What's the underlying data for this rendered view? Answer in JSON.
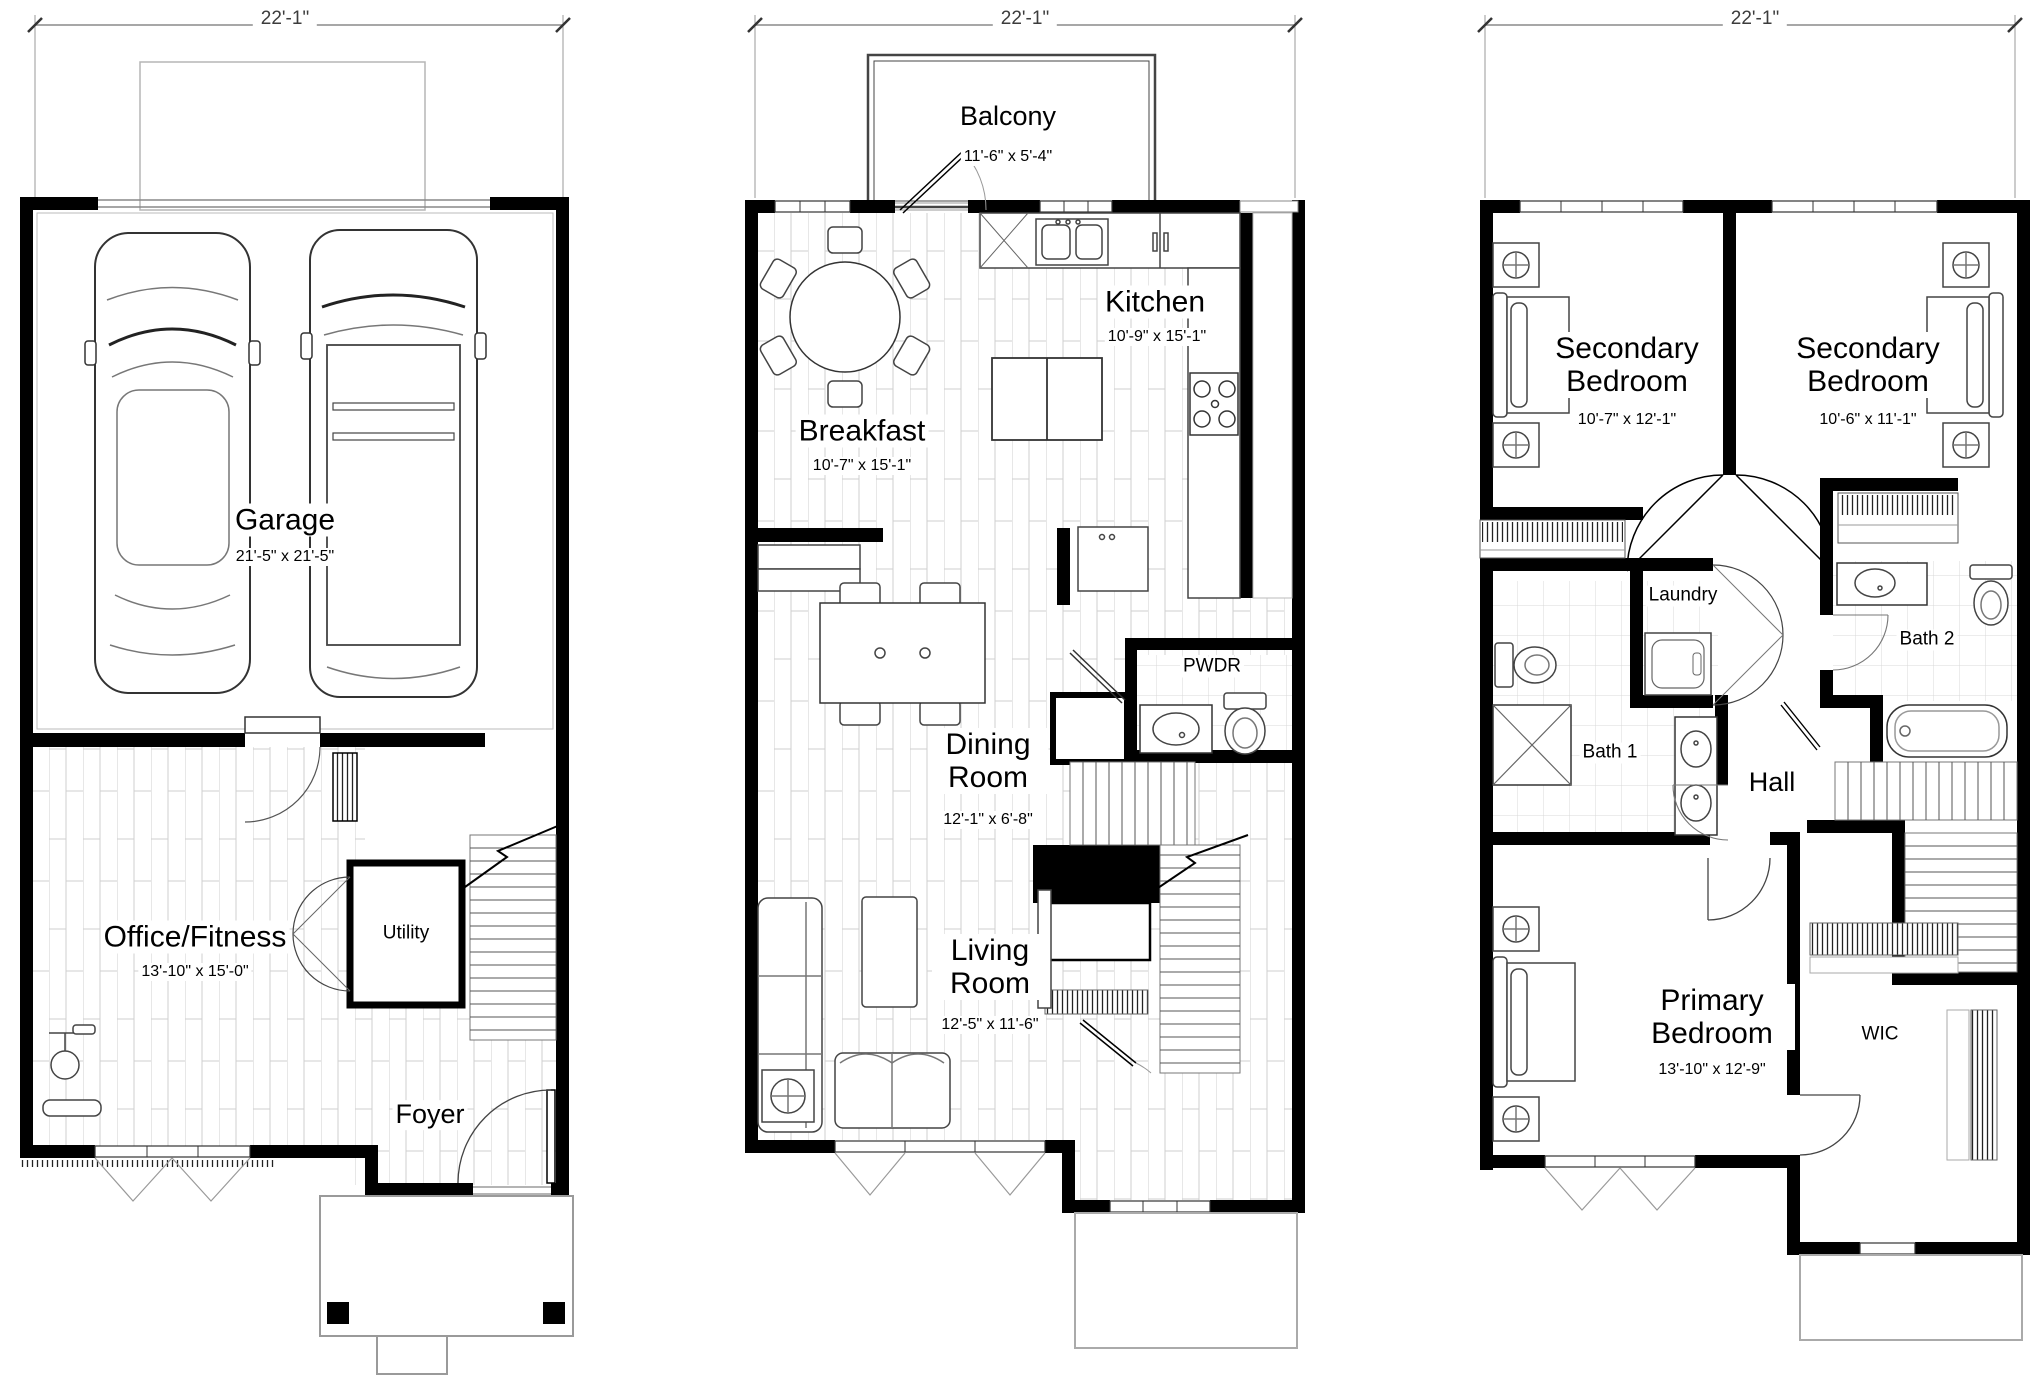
{
  "colors": {
    "wall": "#000000",
    "furniture_outline": "#444444",
    "floor_line": "#cfcfcf",
    "dimension_line": "#8a8a8a"
  },
  "plans": [
    {
      "name": "first-floor",
      "dimension": "22'-1\"",
      "rooms": [
        {
          "name": "Garage",
          "dims": "21'-5\" x 21'-5\""
        },
        {
          "name": "Office/Fitness",
          "dims": "13'-10\" x 15'-0\""
        },
        {
          "name": "Utility"
        },
        {
          "name": "Foyer"
        }
      ]
    },
    {
      "name": "second-floor",
      "dimension": "22'-1\"",
      "rooms": [
        {
          "name": "Balcony",
          "dims": "11'-6\" x 5'-4\""
        },
        {
          "name": "Kitchen",
          "dims": "10'-9\" x 15'-1\""
        },
        {
          "name": "Breakfast",
          "dims": "10'-7\" x 15'-1\""
        },
        {
          "name": "Dining Room",
          "dims": "12'-1\" x 6'-8\""
        },
        {
          "name": "PWDR"
        },
        {
          "name": "Living Room",
          "dims": "12'-5\" x 11'-6\""
        }
      ]
    },
    {
      "name": "third-floor",
      "dimension": "22'-1\"",
      "rooms": [
        {
          "name": "Secondary Bedroom",
          "dims": "10'-7\" x 12'-1\""
        },
        {
          "name": "Secondary Bedroom",
          "dims": "10'-6\" x 11'-1\""
        },
        {
          "name": "Laundry"
        },
        {
          "name": "Bath 1"
        },
        {
          "name": "Bath 2"
        },
        {
          "name": "Hall"
        },
        {
          "name": "Primary Bedroom",
          "dims": "13'-10\" x 12'-9\""
        },
        {
          "name": "WIC"
        }
      ]
    }
  ]
}
